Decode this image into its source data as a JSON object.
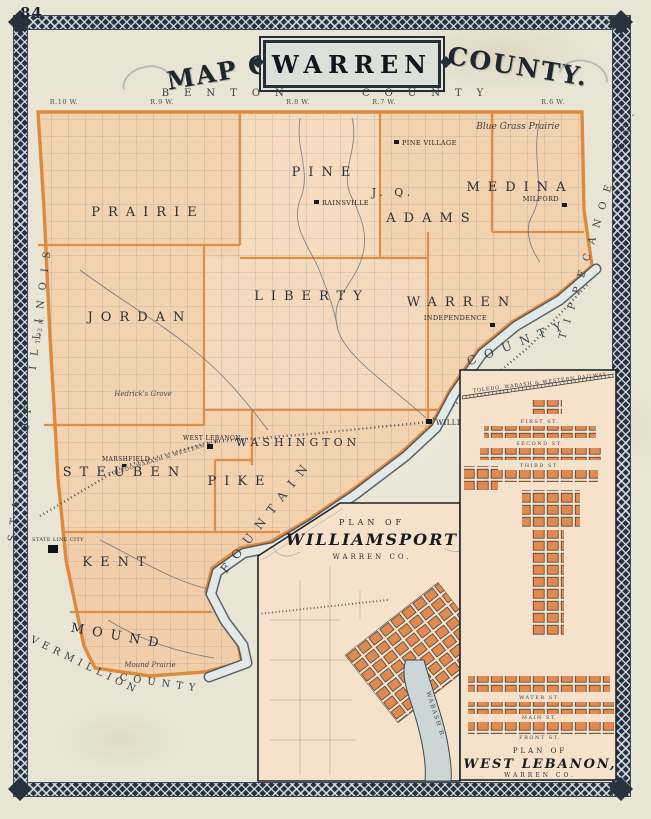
{
  "page_number": "84",
  "title": {
    "map_of": "MAP OF",
    "name": "WARREN",
    "county": "COUNTY."
  },
  "edge_labels": {
    "top": "BENTON COUNTY",
    "left": "STATE OF ILLINOIS",
    "right": "TIPPECANOE CO.",
    "bottom_word1": "VERMILLION",
    "bottom_word2": "COUNTY",
    "river_word1": "FOUNTAIN",
    "river_word2": "COUNTY",
    "tier": "T.23 N."
  },
  "range_labels": [
    "R.10 W.",
    "R.9 W.",
    "R.8 W.",
    "R.7 W.",
    "R.6 W."
  ],
  "townships": [
    "PRAIRIE",
    "PINE",
    "J. Q.",
    "ADAMS",
    "MEDINA",
    "JORDAN",
    "LIBERTY",
    "WARREN",
    "STEUBEN",
    "WASHINGTON",
    "PIKE",
    "KENT",
    "MOUND"
  ],
  "towns": [
    "PINE VILLAGE",
    "RAINSVILLE",
    "MILFORD",
    "INDEPENDENCE",
    "WILLIAMSPORT",
    "WEST LEBANON",
    "MARSHFIELD",
    "STATE LINE CITY"
  ],
  "place_labels": {
    "blue_grass": "Blue Grass Prairie",
    "mound_prairie": "Mound Prairie",
    "hedricks": "Hedrick's Grove"
  },
  "railroads": {
    "main": "TOLEDO WABASH & WESTERN R.W.",
    "west_lebanon": "TOLEDO, WABASH & WESTERN RAILWAY"
  },
  "insets": {
    "williamsport": {
      "plan_of": "PLAN OF",
      "name": "WILLIAMSPORT",
      "county": "WARREN CO.",
      "river": "WABASH R."
    },
    "west_lebanon": {
      "plan_of": "PLAN OF",
      "name": "WEST LEBANON,",
      "county": "WARREN CO.",
      "streets": [
        "FIRST ST.",
        "SECOND ST.",
        "THIRD ST.",
        "WATER ST.",
        "MAIN ST.",
        "FRONT ST."
      ]
    }
  },
  "colors": {
    "paper": "#e9e5d5",
    "map_fill": "#f3d2b0",
    "boundary_orange": "#dd8a3e",
    "river_fill": "#e2e9e6",
    "ink": "#262c35",
    "border_band": "#27323e",
    "inset_fill": "#f6e2ca",
    "town_block": "#e08a52"
  }
}
